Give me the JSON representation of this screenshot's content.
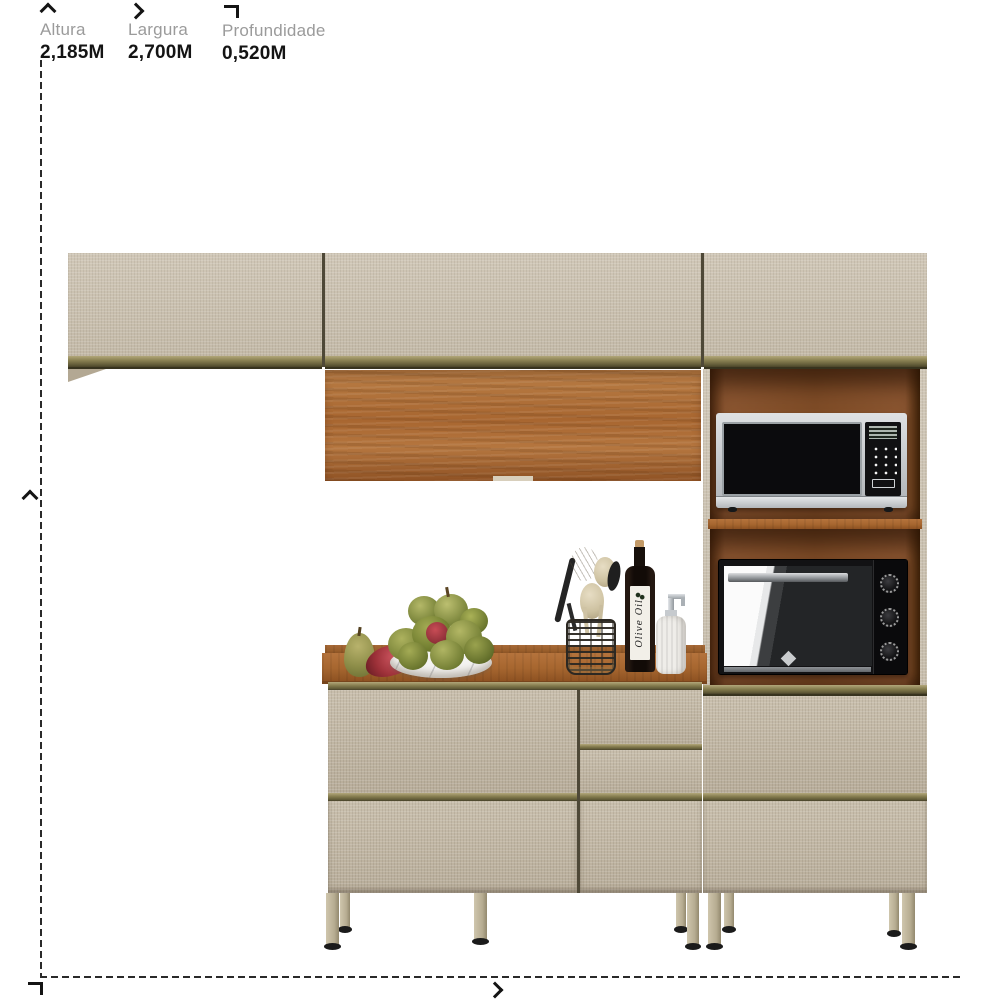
{
  "header": {
    "dimensions": [
      {
        "id": "altura",
        "icon": "chevron-up-icon",
        "label": "Altura",
        "value": "2,185M"
      },
      {
        "id": "largura",
        "icon": "chevron-right-icon",
        "label": "Largura",
        "value": "2,700M"
      },
      {
        "id": "profundidade",
        "icon": "depth-corner-icon",
        "label": "Profundidade",
        "value": "0,520M"
      }
    ]
  },
  "scene": {
    "description": "Kitchen cabinet set product image with dimension guides: wall cabinets, wood flip door, tall tower with microwave and oven niches, counter unit with drawers and countertop decor",
    "bottle_label": "Olive Oil"
  },
  "colors": {
    "background": "#ffffff",
    "label_gray": "#9b9b9b",
    "value_black": "#141414",
    "dash_line": "#2a2a2a",
    "cabinet_beige": "#c8bfae",
    "trim_champagne": "#837a4d",
    "wood": "#a86630",
    "niche_wood": "#7d4b26",
    "appliance_silver": "#c3c6c9",
    "appliance_black": "#141416"
  }
}
